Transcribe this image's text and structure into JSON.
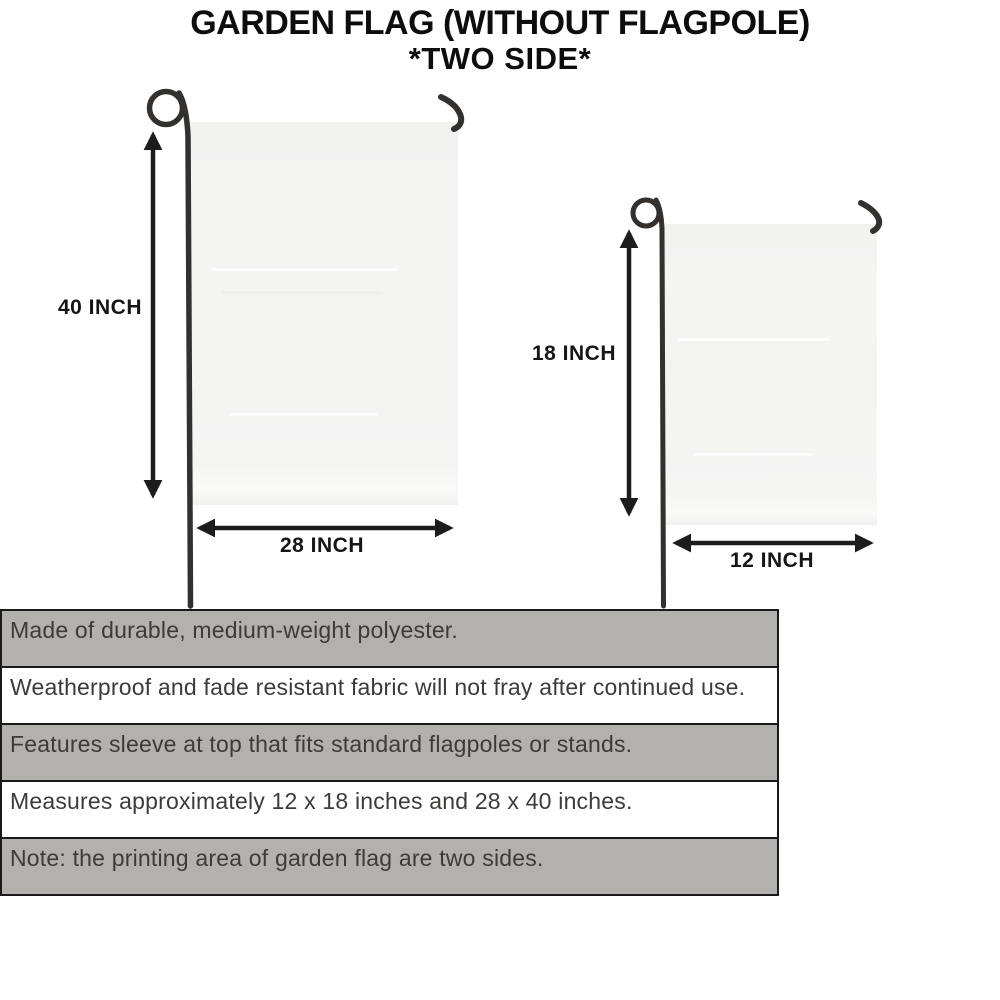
{
  "title": {
    "line1": "GARDEN FLAG (WITHOUT FLAGPOLE)",
    "line2": "*TWO SIDE*"
  },
  "diagram": {
    "large_flag": {
      "height_label": "40 INCH",
      "width_label": "28 INCH"
    },
    "small_flag": {
      "height_label": "18 INCH",
      "width_label": "12 INCH"
    }
  },
  "features": [
    "Made of durable, medium-weight polyester.",
    "Weatherproof and fade resistant fabric will not fray after continued use.",
    "Features sleeve at top that fits standard flagpoles or stands.",
    "Measures approximately 12 x 18 inches and 28 x 40 inches.",
    "Note: the printing area of garden flag are two sides."
  ],
  "colors": {
    "row_gray": "#b3b1ae",
    "row_white": "#ffffff",
    "border_dark": "#1a1a1a",
    "flag_fill": "#f4f4f3",
    "pole": "#33302d",
    "arrow": "#1c1c1c",
    "text_title": "#0d0d0d",
    "text_label": "#161616",
    "text_row": "#3d3b39"
  }
}
